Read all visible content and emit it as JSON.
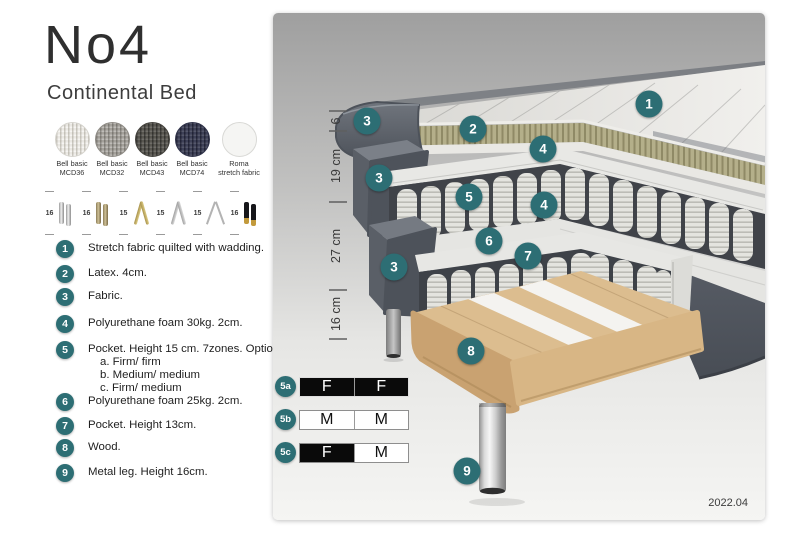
{
  "title": "No4",
  "subtitle": "Continental Bed",
  "fabric_swatches": [
    {
      "line1": "Bell basic",
      "line2": "MCD36"
    },
    {
      "line1": "Bell basic",
      "line2": "MCD32"
    },
    {
      "line1": "Bell basic",
      "line2": "MCD43"
    },
    {
      "line1": "Bell basic",
      "line2": "MCD74"
    },
    {
      "line1": "Roma",
      "line2": "stretch fabric"
    }
  ],
  "leg_options": [
    {
      "height": "16",
      "style": "chrome cylinder legs"
    },
    {
      "height": "16",
      "style": "brass cylinder legs"
    },
    {
      "height": "15",
      "style": "gold twisted legs"
    },
    {
      "height": "15",
      "style": "silver twisted legs"
    },
    {
      "height": "15",
      "style": "hairpin metal leg"
    },
    {
      "height": "16",
      "style": "black legs with gold tip"
    }
  ],
  "parts_list": [
    {
      "num": "1",
      "text": "Stretch fabric quilted with wadding."
    },
    {
      "num": "2",
      "text": "Latex. 4cm."
    },
    {
      "num": "3",
      "text": "Fabric."
    },
    {
      "num": "4",
      "text": "Polyurethane foam 30kg. 2cm."
    },
    {
      "num": "5",
      "text": "Pocket. Height 15 cm. 7zones. Option:",
      "options": [
        "a. Firm/ firm",
        "b. Medium/ medium",
        "c. Firm/ medium"
      ]
    },
    {
      "num": "6",
      "text": "Polyurethane foam 25kg. 2cm."
    },
    {
      "num": "7",
      "text": "Pocket. Height 13cm."
    },
    {
      "num": "8",
      "text": "Wood."
    },
    {
      "num": "9",
      "text": "Metal leg. Height 16cm."
    }
  ],
  "illustration": {
    "badges": [
      "1",
      "2",
      "3",
      "4",
      "3",
      "5",
      "4",
      "6",
      "7",
      "3",
      "8",
      "9"
    ],
    "dimensions": [
      "6",
      "19 cm",
      "27 cm",
      "16 cm"
    ]
  },
  "firmness": [
    {
      "label": "5a",
      "cells": [
        "F",
        "F"
      ]
    },
    {
      "label": "5b",
      "cells": [
        "M",
        "M"
      ]
    },
    {
      "label": "5c",
      "cells": [
        "F",
        "M"
      ]
    }
  ],
  "version": "2022.04",
  "colors": {
    "badge_teal": "#2d6e74",
    "latex_khaki": "#b2ad88",
    "wood": "#dcbd8f",
    "fabric_dark_gray": "#4e535b"
  }
}
